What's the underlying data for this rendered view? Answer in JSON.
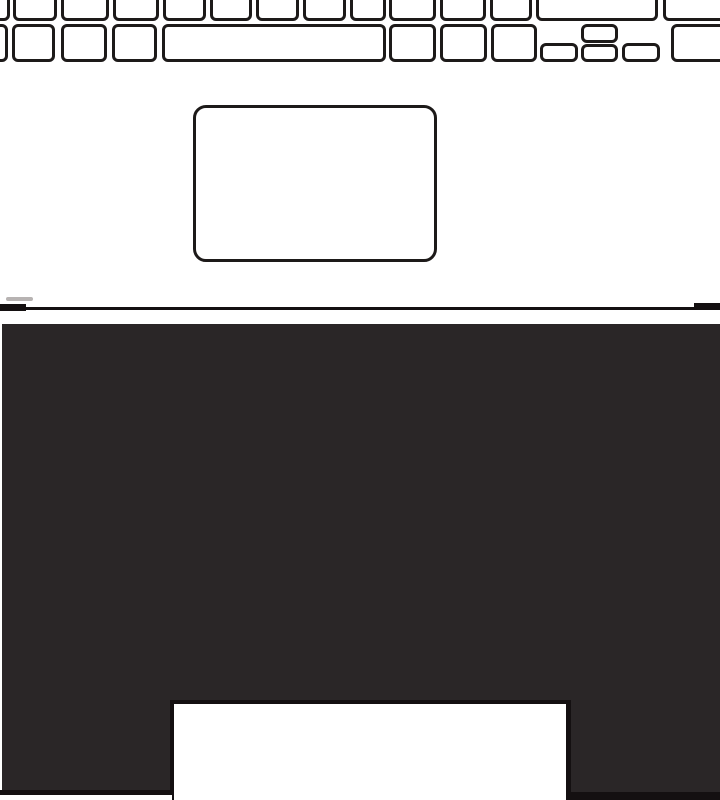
{
  "illustration": {
    "kind": "line-drawing",
    "subject": "laptop-lower-deck-with-keyboard-trackpad-and-front-panel-cutout"
  },
  "colors": {
    "background": "#ffffff",
    "line": "#1d1a19",
    "panel": "#2a2627",
    "edge": "#141011",
    "smudge": "#b7b3b2",
    "white": "#ffffff"
  },
  "shapes": [
    {
      "name": "keyboard-key",
      "type": "key",
      "x": -30,
      "y": -16,
      "w": 40,
      "h": 37
    },
    {
      "name": "keyboard-key",
      "type": "key",
      "x": 13,
      "y": -16,
      "w": 44,
      "h": 37
    },
    {
      "name": "keyboard-key",
      "type": "key",
      "x": 61,
      "y": -16,
      "w": 48,
      "h": 37
    },
    {
      "name": "keyboard-key",
      "type": "key",
      "x": 113,
      "y": -16,
      "w": 46,
      "h": 37
    },
    {
      "name": "keyboard-key",
      "type": "key",
      "x": 163,
      "y": -16,
      "w": 43,
      "h": 37
    },
    {
      "name": "keyboard-key",
      "type": "key",
      "x": 210,
      "y": -16,
      "w": 42,
      "h": 37
    },
    {
      "name": "keyboard-key",
      "type": "key",
      "x": 256,
      "y": -16,
      "w": 43,
      "h": 37
    },
    {
      "name": "keyboard-key",
      "type": "key",
      "x": 303,
      "y": -16,
      "w": 43,
      "h": 37
    },
    {
      "name": "keyboard-key",
      "type": "key",
      "x": 350,
      "y": -16,
      "w": 36,
      "h": 37
    },
    {
      "name": "keyboard-key",
      "type": "key",
      "x": 389,
      "y": -16,
      "w": 47,
      "h": 37
    },
    {
      "name": "keyboard-key",
      "type": "key",
      "x": 440,
      "y": -16,
      "w": 46,
      "h": 37
    },
    {
      "name": "keyboard-key",
      "type": "key",
      "x": 490,
      "y": -16,
      "w": 42,
      "h": 37
    },
    {
      "name": "keyboard-key-wide",
      "type": "key",
      "x": 536,
      "y": -16,
      "w": 122,
      "h": 37
    },
    {
      "name": "keyboard-key",
      "type": "key",
      "x": 663,
      "y": -16,
      "w": 75,
      "h": 37
    },
    {
      "name": "keyboard-key",
      "type": "key",
      "x": -25,
      "y": 24,
      "w": 33,
      "h": 38
    },
    {
      "name": "keyboard-key",
      "type": "key",
      "x": 12,
      "y": 24,
      "w": 43,
      "h": 38
    },
    {
      "name": "keyboard-key",
      "type": "key",
      "x": 61,
      "y": 24,
      "w": 46,
      "h": 38
    },
    {
      "name": "keyboard-key",
      "type": "key",
      "x": 112,
      "y": 24,
      "w": 45,
      "h": 38
    },
    {
      "name": "spacebar-key",
      "type": "key",
      "x": 162,
      "y": 24,
      "w": 224,
      "h": 38
    },
    {
      "name": "keyboard-key",
      "type": "key",
      "x": 389,
      "y": 24,
      "w": 47,
      "h": 38
    },
    {
      "name": "keyboard-key",
      "type": "key",
      "x": 440,
      "y": 24,
      "w": 47,
      "h": 38
    },
    {
      "name": "keyboard-key",
      "type": "key",
      "x": 491,
      "y": 24,
      "w": 46,
      "h": 38
    },
    {
      "name": "arrow-left-key",
      "type": "key",
      "x": 540,
      "y": 43,
      "w": 38,
      "h": 19
    },
    {
      "name": "arrow-up-key",
      "type": "key",
      "x": 581,
      "y": 24,
      "w": 37,
      "h": 19
    },
    {
      "name": "arrow-down-key",
      "type": "key",
      "x": 581,
      "y": 44,
      "w": 37,
      "h": 18
    },
    {
      "name": "arrow-right-key",
      "type": "key",
      "x": 622,
      "y": 43,
      "w": 38,
      "h": 19
    },
    {
      "name": "keyboard-key",
      "type": "key",
      "x": 671,
      "y": 24,
      "w": 70,
      "h": 38
    },
    {
      "name": "trackpad",
      "type": "pad",
      "x": 193,
      "y": 105,
      "w": 244,
      "h": 157
    },
    {
      "name": "smudge-mark",
      "type": "fill",
      "x": 6,
      "y": 297,
      "w": 27,
      "h": 4,
      "color": "smudge",
      "r": 2
    },
    {
      "name": "hinge-line",
      "type": "fill",
      "x": 0,
      "y": 307,
      "w": 720,
      "h": 3,
      "color": "edge"
    },
    {
      "name": "hinge-line-left-cap",
      "type": "fill",
      "x": 0,
      "y": 304,
      "w": 26,
      "h": 7,
      "color": "edge"
    },
    {
      "name": "hinge-line-right-cap",
      "type": "fill",
      "x": 694,
      "y": 303,
      "w": 26,
      "h": 7,
      "color": "edge"
    },
    {
      "name": "front-panel",
      "type": "fill",
      "x": 2,
      "y": 324,
      "w": 718,
      "h": 476,
      "color": "panel"
    },
    {
      "name": "notch-cutout-border",
      "type": "fill",
      "x": 170,
      "y": 700,
      "w": 401,
      "h": 100,
      "color": "edge"
    },
    {
      "name": "notch-cutout",
      "type": "fill",
      "x": 174,
      "y": 704,
      "w": 392,
      "h": 96,
      "color": "white"
    },
    {
      "name": "panel-bottom-left-edge",
      "type": "fill",
      "x": 0,
      "y": 790,
      "w": 172,
      "h": 5,
      "color": "edge"
    },
    {
      "name": "panel-bottom-left-gap",
      "type": "fill",
      "x": 0,
      "y": 795,
      "w": 172,
      "h": 5,
      "color": "white"
    },
    {
      "name": "panel-bottom-right-edge",
      "type": "fill",
      "x": 571,
      "y": 792,
      "w": 149,
      "h": 8,
      "color": "edge"
    }
  ]
}
